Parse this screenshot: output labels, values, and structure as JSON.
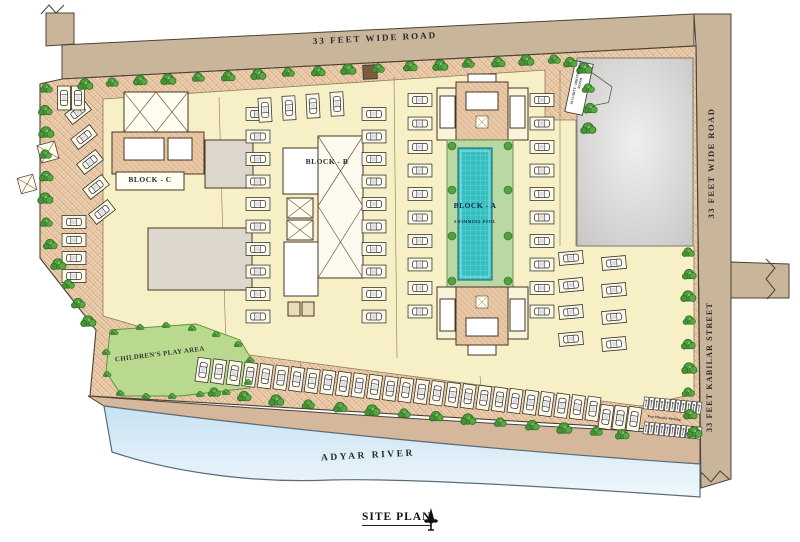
{
  "roads": {
    "top_road": "33 FEET WIDE ROAD",
    "right_road": "33 FEET WIDE ROAD",
    "kabilar_street": "33 FEET KABILAR STREET"
  },
  "blocks": {
    "block_a": {
      "label": "BLOCK - A",
      "sublabel": "SWIMMING POOL"
    },
    "block_b": {
      "label": "BLOCK - B"
    },
    "block_c": {
      "label": "BLOCK - C"
    }
  },
  "areas": {
    "play_area": "CHILDREN'S PLAY AREA",
    "river": "ADYAR RIVER",
    "two_wheeler_parking": "Two Wheeler Parking",
    "security_room": "SECURITY / DRIVERS REST ROOM"
  },
  "legend": {
    "title": "SITE PLAN"
  },
  "colors": {
    "road": "#c9b59a",
    "setback_hatch": "#ecd2b2",
    "paving": "#f7f0c6",
    "pool": "#35bfc0",
    "pool_deck": "#b9d8a3",
    "play_area": "#b9d98e",
    "river": "#d6e9f5",
    "tree": "#4f9e3d",
    "vacant_plot": "#d9d9d9"
  }
}
